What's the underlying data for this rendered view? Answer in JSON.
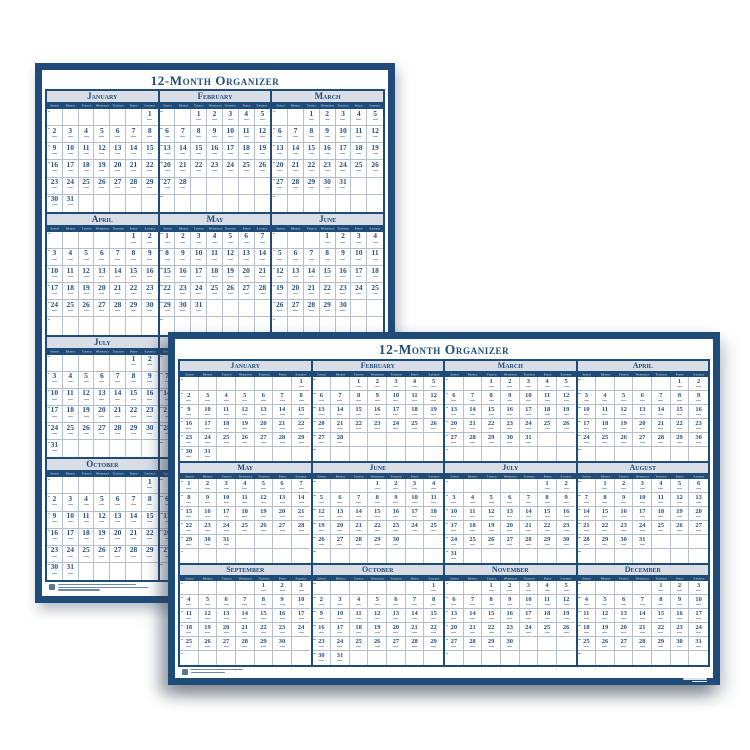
{
  "title": "12-Month Organizer",
  "weekdays": [
    "Sunday",
    "Monday",
    "Tuesday",
    "Wednesday",
    "Thursday",
    "Friday",
    "Saturday"
  ],
  "months": [
    {
      "name": "January",
      "start_dow": 6,
      "days": 31
    },
    {
      "name": "February",
      "start_dow": 2,
      "days": 28
    },
    {
      "name": "March",
      "start_dow": 2,
      "days": 31
    },
    {
      "name": "April",
      "start_dow": 5,
      "days": 30
    },
    {
      "name": "May",
      "start_dow": 0,
      "days": 31
    },
    {
      "name": "June",
      "start_dow": 3,
      "days": 30
    },
    {
      "name": "July",
      "start_dow": 5,
      "days": 31
    },
    {
      "name": "August",
      "start_dow": 1,
      "days": 31
    },
    {
      "name": "September",
      "start_dow": 4,
      "days": 30
    },
    {
      "name": "October",
      "start_dow": 6,
      "days": 31
    },
    {
      "name": "November",
      "start_dow": 2,
      "days": 30
    },
    {
      "name": "December",
      "start_dow": 4,
      "days": 31
    }
  ],
  "calendars": {
    "back": {
      "title": "12-Month Organizer",
      "orientation": "portrait",
      "columns": 3,
      "rows": 4,
      "visible_months": [
        "January",
        "February",
        "March",
        "April",
        "May",
        "June",
        "July",
        "October"
      ]
    },
    "front": {
      "title": "12-Month Organizer",
      "orientation": "landscape",
      "columns": 4,
      "rows": 3,
      "visible_months": [
        "January",
        "February",
        "March",
        "April",
        "May",
        "June",
        "July",
        "August",
        "September",
        "October",
        "November",
        "December"
      ]
    }
  },
  "colors": {
    "navy_frame": "#1f4b78",
    "month_header_bg": "#d9dde6",
    "grid_line": "#b6bfce",
    "date_text": "#27507f",
    "weekday_text": "#eef1f6",
    "page_background": "#ffffff"
  }
}
